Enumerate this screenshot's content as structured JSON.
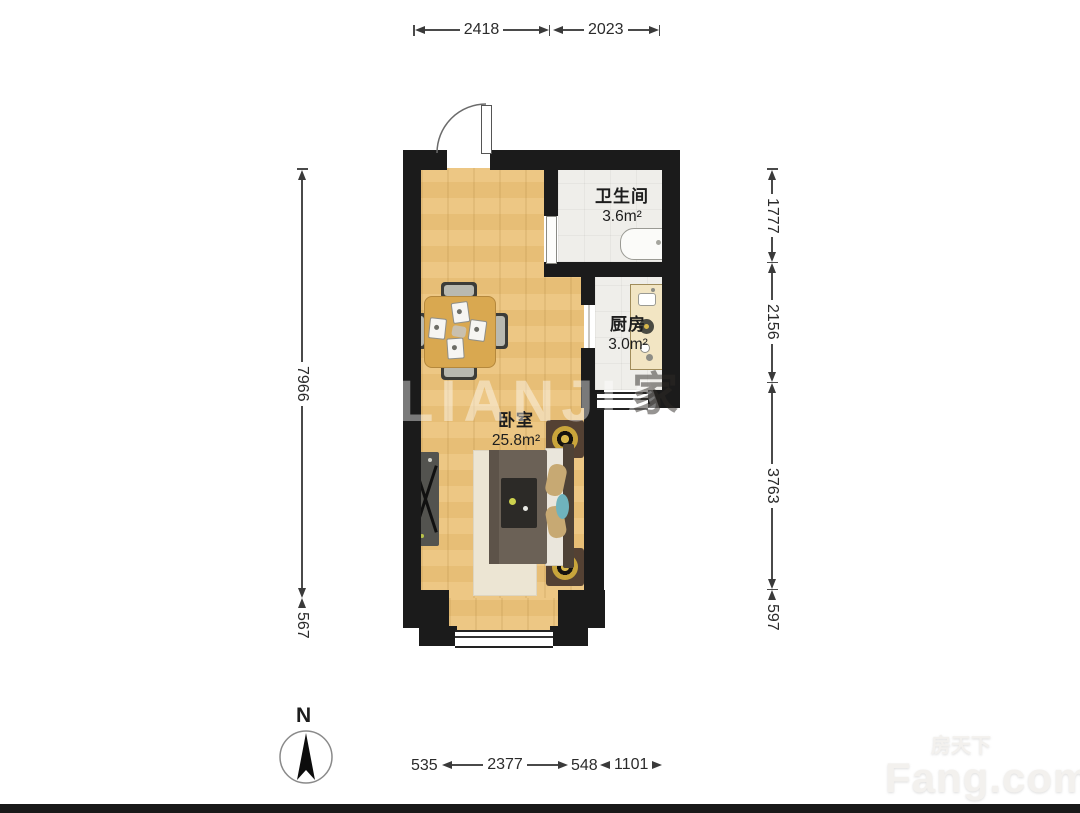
{
  "rooms": {
    "bathroom": {
      "name": "卫生间",
      "area": "3.6m²"
    },
    "kitchen": {
      "name": "厨房",
      "area": "3.0m²"
    },
    "bedroom": {
      "name": "卧室",
      "area": "25.8m²"
    }
  },
  "dimensions": {
    "top": [
      "2418",
      "2023"
    ],
    "left": [
      "7966",
      "567"
    ],
    "right": [
      "1777",
      "2156",
      "3763",
      "597"
    ],
    "bottom": [
      "535",
      "2377",
      "548",
      "1101"
    ]
  },
  "compass": {
    "north_label": "N"
  },
  "watermarks": {
    "center": "LIANJIA",
    "glyph": "家",
    "brand_cn": "房天下",
    "brand_en": "Fang.com"
  },
  "colors": {
    "wall": "#1b1b1b",
    "wood_floor": "#ecc47c",
    "tile_floor": "#efeeea",
    "lamp_gold": "#caa53b",
    "dimension_text": "#2b2b2b"
  }
}
